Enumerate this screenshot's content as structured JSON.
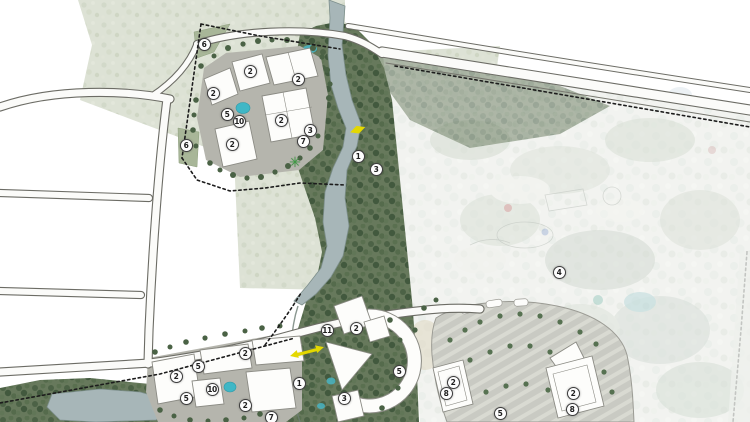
{
  "map": {
    "type": "site-master-plan-overlay",
    "colors": {
      "background": "#ffffff",
      "sage_texture": "#dde2d5",
      "aerial_faded": "#e8ebe5",
      "vegetation": "#67795c",
      "water": "#a7b6b8",
      "pool": "#43b4c2",
      "plaza": "#b5b5ad",
      "parking": "#c9cac3",
      "building": "#fdfdfb",
      "road_casing": "#6c6c65",
      "boundary_dotted": "#1c1c1c",
      "arrow_accent": "#e4d800",
      "star_accent": "#3d9a43",
      "green_wedge": "#a8b698"
    },
    "marker_style": "numbered white circles",
    "markers": [
      {
        "label": "6",
        "x": 204,
        "y": 44
      },
      {
        "label": "2",
        "x": 250,
        "y": 71
      },
      {
        "label": "2",
        "x": 298,
        "y": 79
      },
      {
        "label": "2",
        "x": 213,
        "y": 93
      },
      {
        "label": "5",
        "x": 227,
        "y": 114
      },
      {
        "label": "10",
        "x": 239,
        "y": 121
      },
      {
        "label": "2",
        "x": 281,
        "y": 120
      },
      {
        "label": "3",
        "x": 310,
        "y": 130
      },
      {
        "label": "7",
        "x": 303,
        "y": 141
      },
      {
        "label": "2",
        "x": 232,
        "y": 144
      },
      {
        "label": "6",
        "x": 186,
        "y": 145
      },
      {
        "label": "1",
        "x": 358,
        "y": 156
      },
      {
        "label": "3",
        "x": 376,
        "y": 169
      },
      {
        "label": "4",
        "x": 559,
        "y": 272
      },
      {
        "label": "11",
        "x": 327,
        "y": 330
      },
      {
        "label": "2",
        "x": 356,
        "y": 328
      },
      {
        "label": "2",
        "x": 245,
        "y": 353
      },
      {
        "label": "5",
        "x": 198,
        "y": 366
      },
      {
        "label": "2",
        "x": 176,
        "y": 376
      },
      {
        "label": "10",
        "x": 212,
        "y": 389
      },
      {
        "label": "5",
        "x": 186,
        "y": 398
      },
      {
        "label": "2",
        "x": 245,
        "y": 405
      },
      {
        "label": "7",
        "x": 271,
        "y": 417
      },
      {
        "label": "1",
        "x": 299,
        "y": 383
      },
      {
        "label": "3",
        "x": 344,
        "y": 398
      },
      {
        "label": "5",
        "x": 399,
        "y": 371
      },
      {
        "label": "5",
        "x": 500,
        "y": 413
      },
      {
        "label": "2",
        "x": 453,
        "y": 382
      },
      {
        "label": "8",
        "x": 446,
        "y": 393
      },
      {
        "label": "2",
        "x": 573,
        "y": 393
      },
      {
        "label": "8",
        "x": 572,
        "y": 409
      }
    ],
    "arrows": [
      {
        "x1": 346,
        "y1": 134,
        "x2": 369,
        "y2": 126
      },
      {
        "x1": 286,
        "y1": 357,
        "x2": 328,
        "y2": 346
      }
    ],
    "stars": [
      {
        "x": 295,
        "y": 163
      }
    ]
  }
}
